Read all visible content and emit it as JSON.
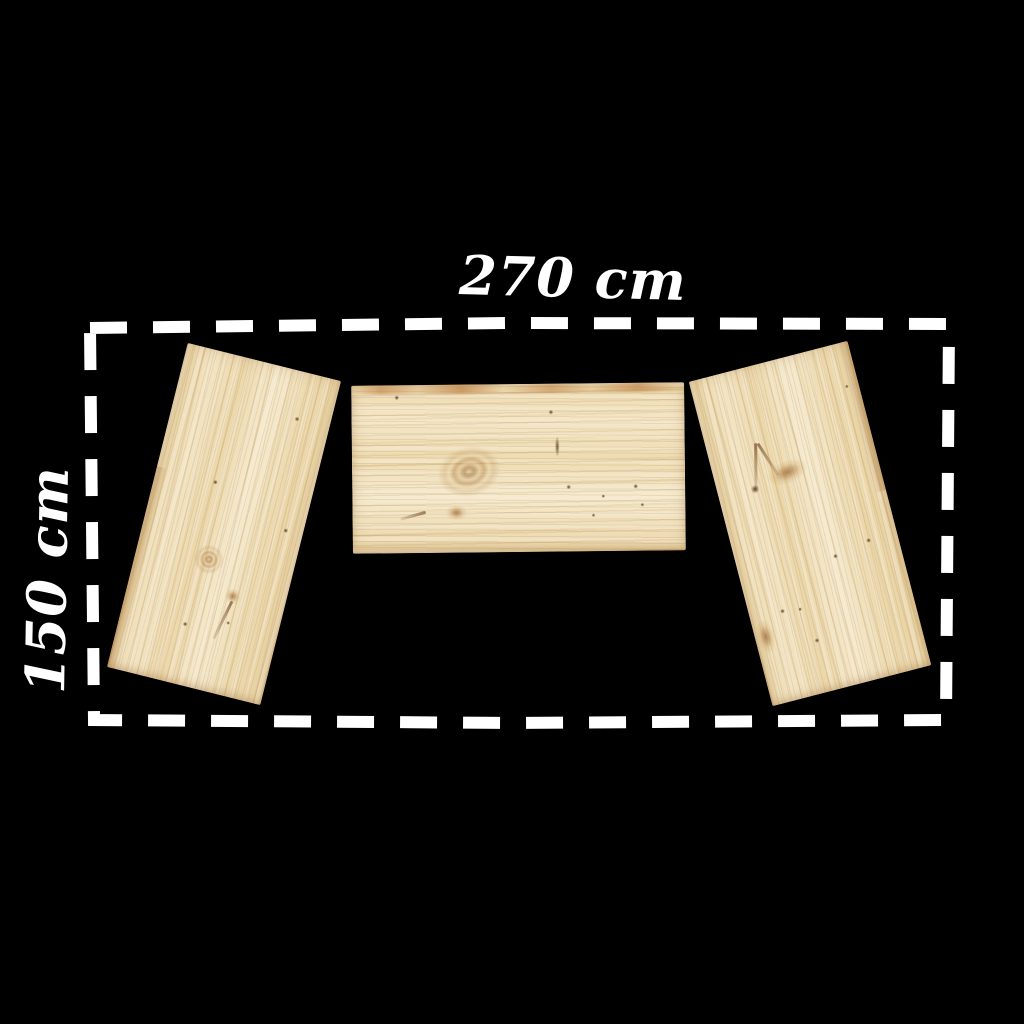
{
  "dimension_labels": {
    "width": "270 cm",
    "height": "150 cm"
  },
  "colors": {
    "background": "#000000",
    "outline_dash": "#ffffff",
    "label_text": "#ffffff",
    "wood_light": "#f6ebd0",
    "wood_base": "#eedcb0",
    "wood_grain": "#d8bd8c",
    "wood_knot": "#b5824e",
    "wood_streak": "#ba7334"
  },
  "panels": [
    {
      "id": "left-plank"
    },
    {
      "id": "center-plank"
    },
    {
      "id": "right-plank"
    }
  ]
}
